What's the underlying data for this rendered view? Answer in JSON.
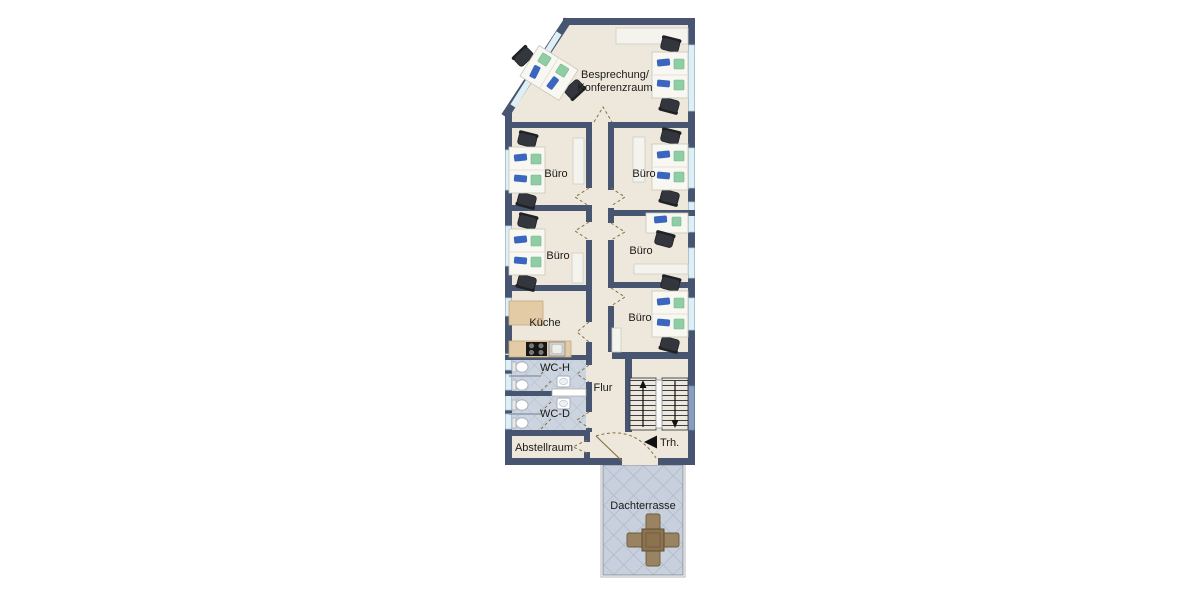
{
  "plan": {
    "rooms": {
      "conference": {
        "label_line1": "Besprechung/",
        "label_line2": "Konferenzraum"
      },
      "offices": [
        "Büro",
        "Büro",
        "Büro",
        "Büro",
        "Büro"
      ],
      "kitchen": {
        "label": "Küche"
      },
      "wc_men": {
        "label": "WC-H"
      },
      "wc_women": {
        "label": "WC-D"
      },
      "hallway": {
        "label": "Flur"
      },
      "storage": {
        "label": "Abstellraum"
      },
      "stairwell": {
        "label": "Trh."
      },
      "roof_terrace": {
        "label": "Dachterrasse"
      }
    },
    "colors": {
      "wall": "#475571",
      "floor": "#EDE8DB",
      "window": "#DFEFF6",
      "wc_tile": "#CBD4DF",
      "terrace_tile": "#C7D0DC",
      "desk_monitor_blue": "#3B66C0",
      "desk_pad_green": "#90CDA5",
      "office_chair": "#33363C",
      "kitchen_counter": "#E3CBA6",
      "terrace_furniture": "#8A734E"
    }
  }
}
